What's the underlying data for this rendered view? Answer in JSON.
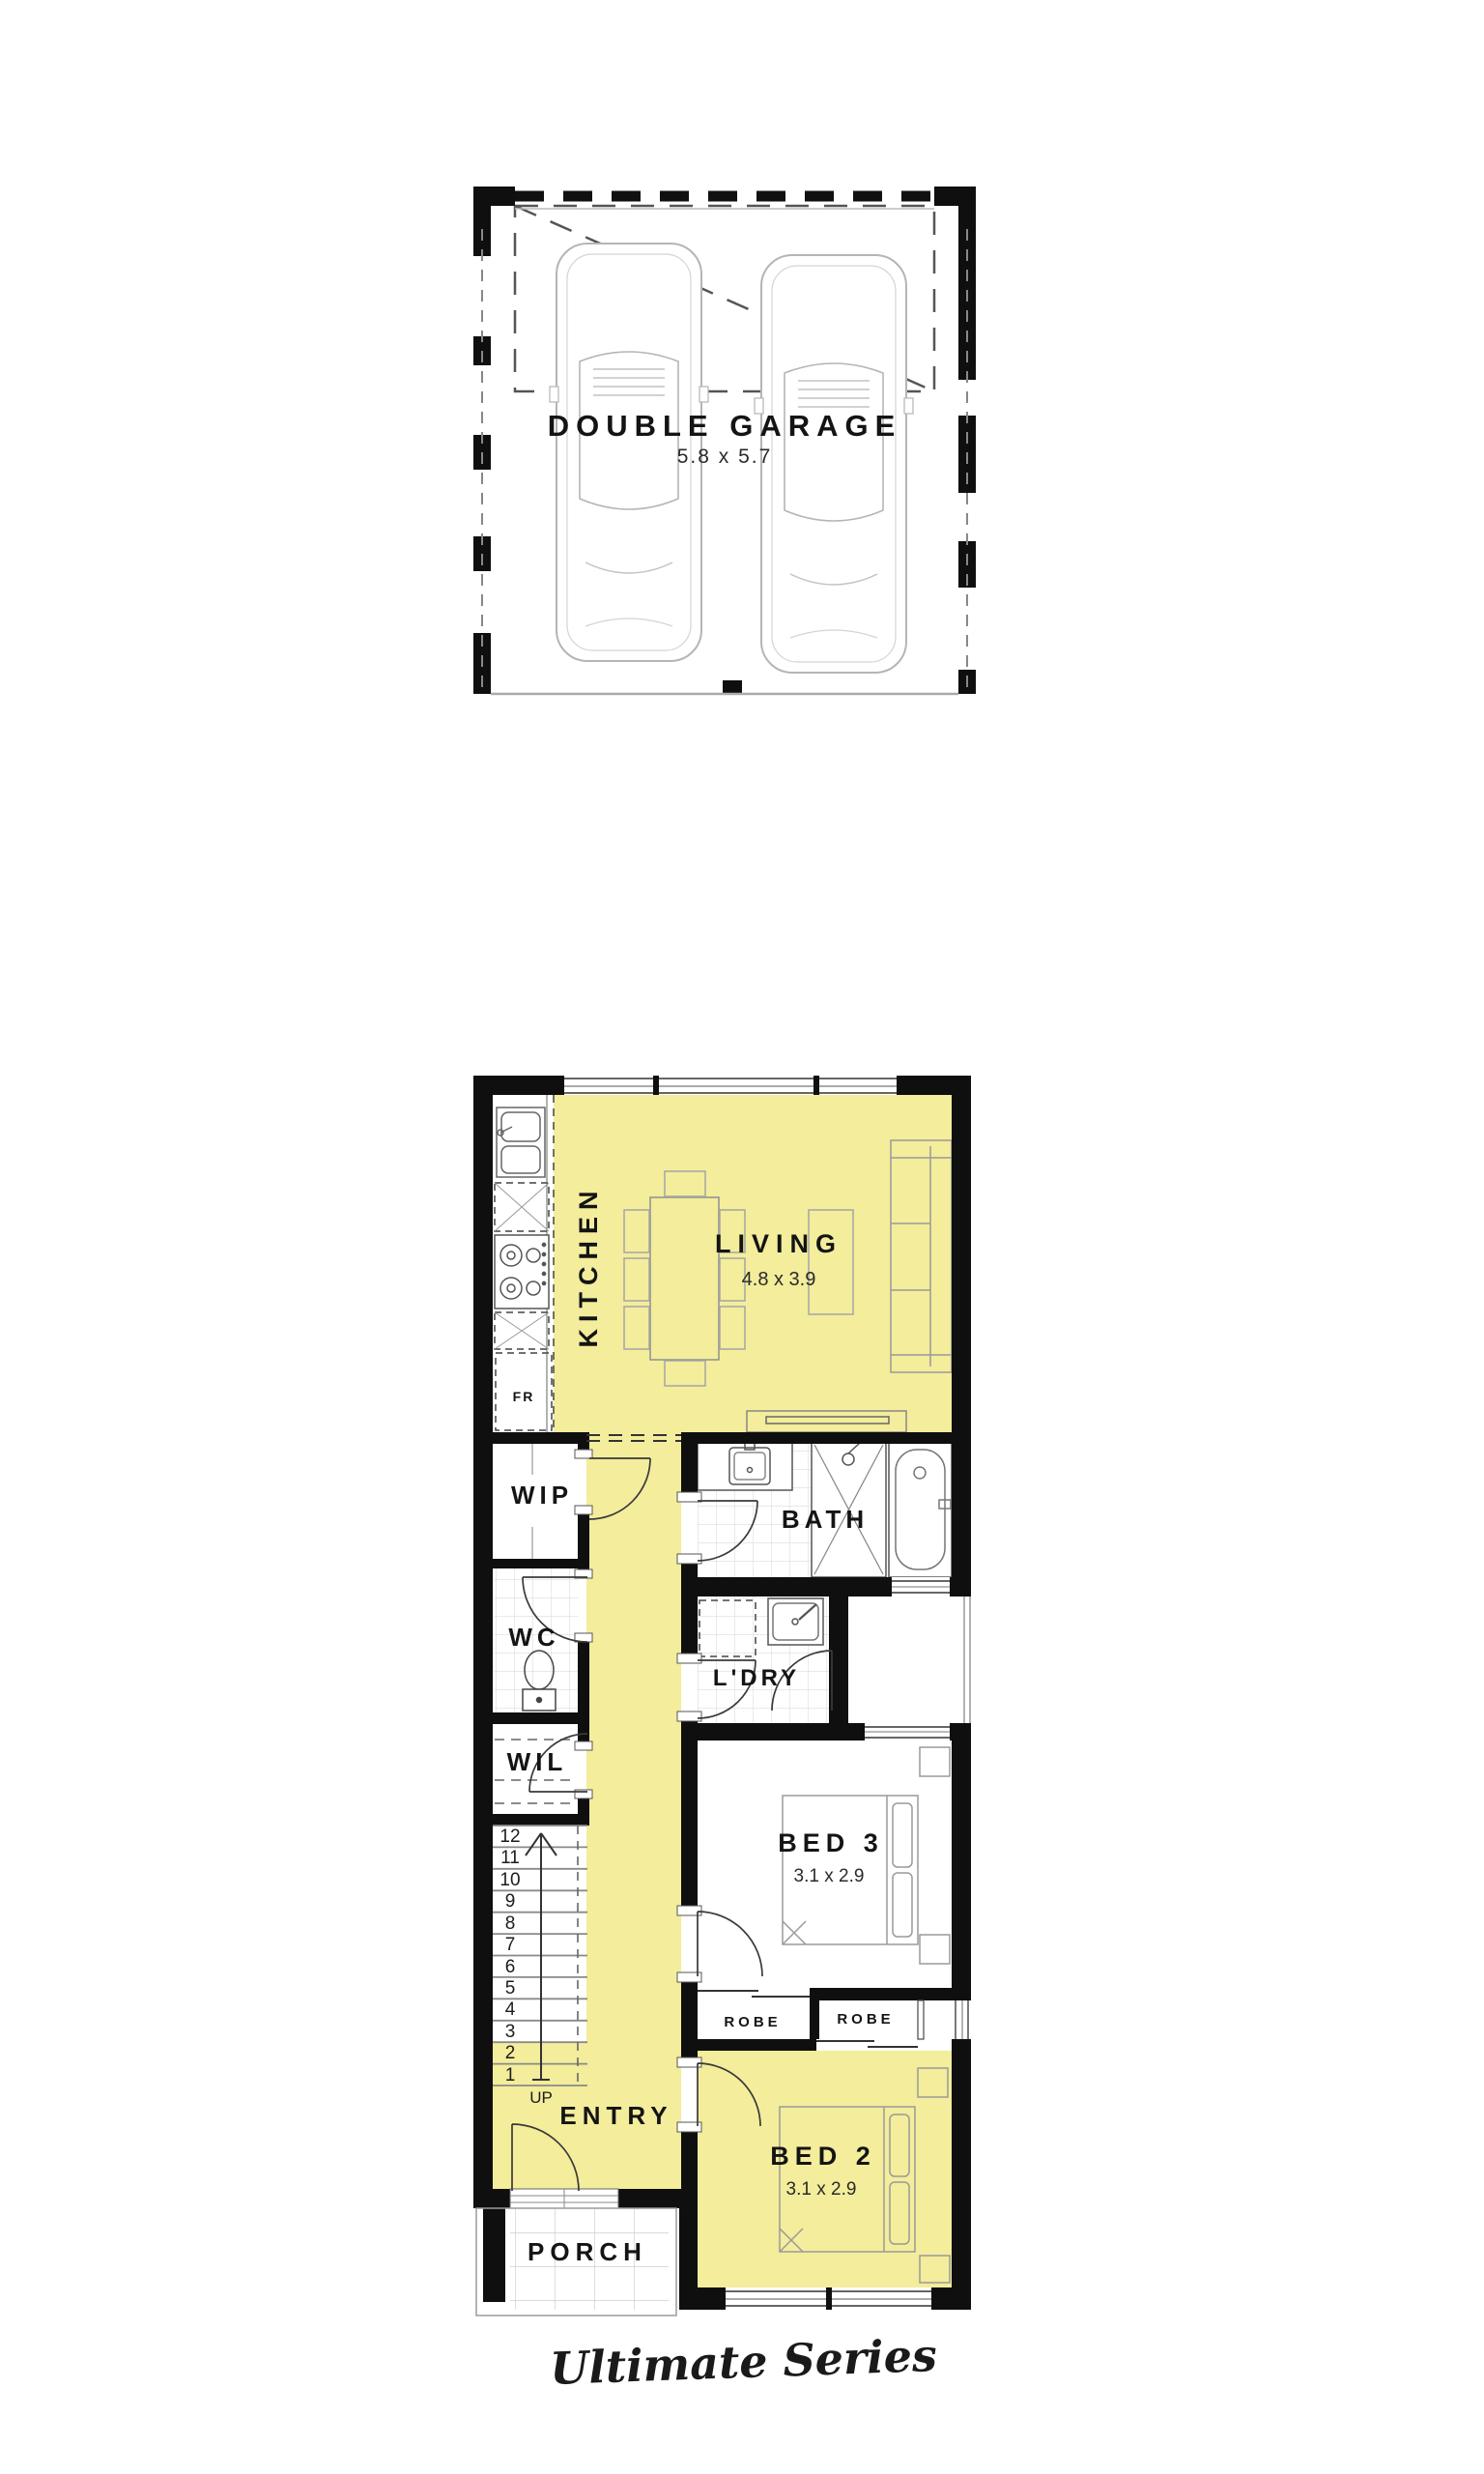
{
  "garage_plan": {
    "room_label": "DOUBLE GARAGE",
    "room_dims": "5.8 x 5.7",
    "cars": [
      "car-top-view-left",
      "car-top-view-right"
    ]
  },
  "ground_plan": {
    "kitchen": {
      "label": "KITCHEN"
    },
    "living": {
      "label": "LIVING",
      "dims": "4.8 x 3.9"
    },
    "fridge": {
      "label": "FR"
    },
    "wip": {
      "label": "WIP"
    },
    "bath": {
      "label": "BATH"
    },
    "wc": {
      "label": "WC"
    },
    "ldry": {
      "label": "L'DRY"
    },
    "wil": {
      "label": "WIL"
    },
    "bed3": {
      "label": "BED 3",
      "dims": "3.1 x 2.9"
    },
    "robe_left": {
      "label": "ROBE"
    },
    "robe_right": {
      "label": "ROBE"
    },
    "entry": {
      "label": "ENTRY"
    },
    "bed2": {
      "label": "BED 2",
      "dims": "3.1 x 2.9"
    },
    "porch": {
      "label": "PORCH"
    },
    "stairs": {
      "direction_label": "UP",
      "steps": [
        "12",
        "11",
        "10",
        "9",
        "8",
        "7",
        "6",
        "5",
        "4",
        "3",
        "2",
        "1"
      ]
    }
  },
  "footer": {
    "series_label": "Ultimate Series"
  },
  "colors": {
    "highlight_floor": "#F3ED9C",
    "wall": "#0F0F0F",
    "furniture_line": "#9A9A9A",
    "tile_line": "#DCDCDC",
    "dash_line": "#555555"
  }
}
